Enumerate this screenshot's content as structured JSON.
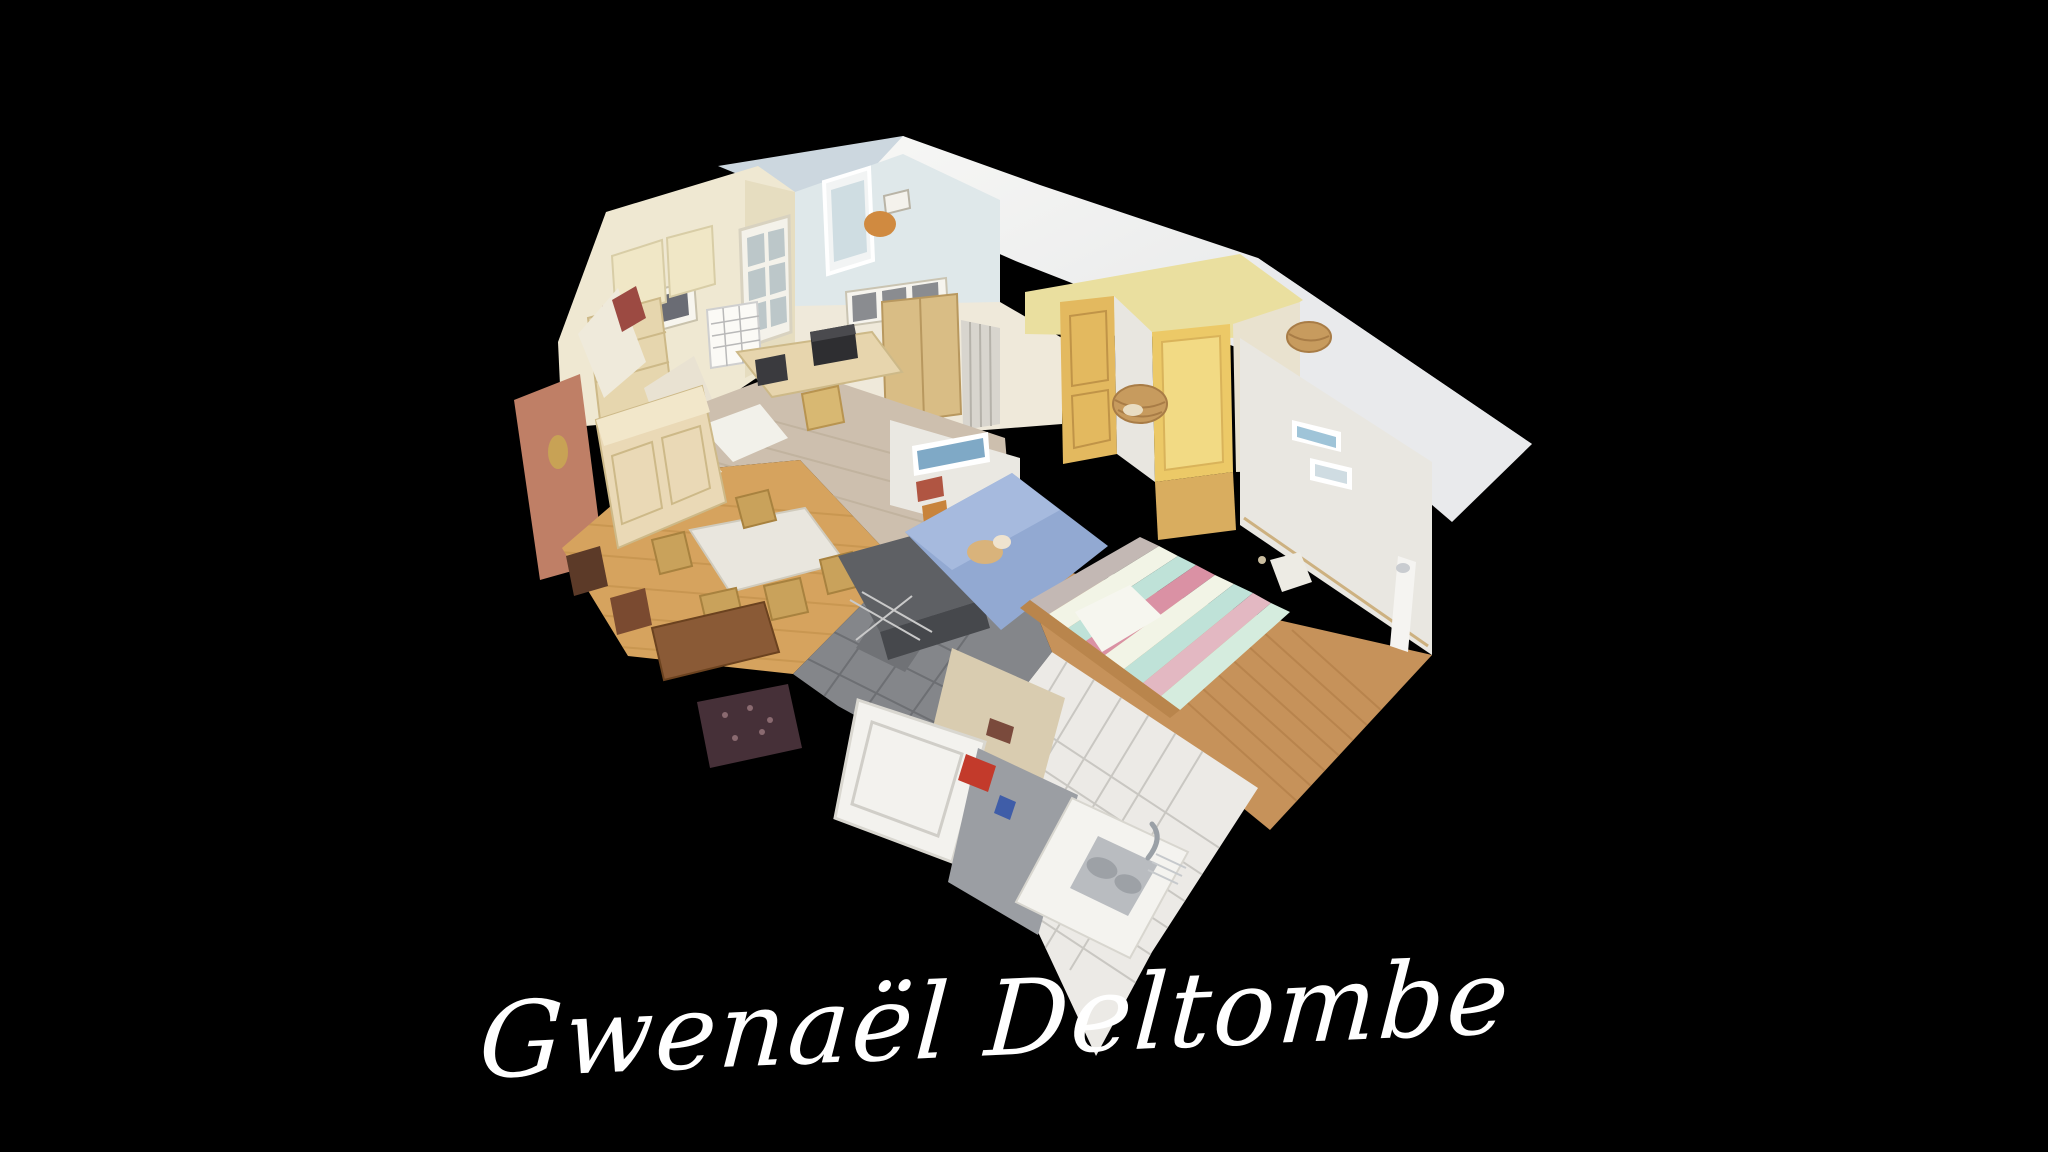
{
  "page": {
    "width_px": 2048,
    "height_px": 1152,
    "background_color": "#000000"
  },
  "scene": {
    "kind": "3d-dollhouse-cutaway",
    "subject": "apartment interior photogrammetry scan viewed from above on black backdrop",
    "rooms_visible": [
      "attic kitchen-dining room with cream gable wall and buffet",
      "office nook with pale blue wall, window, desk and printer",
      "hallway with yellow oak doors",
      "bedroom with blue single bed",
      "bedroom with striped double bed and rattan pendant lamps",
      "bathroom with grey slate floor and white fixtures",
      "white-tiled kitchen corner with steel sink"
    ]
  },
  "watermark": {
    "text": "Gwenaël Deltombe",
    "color": "#ffffff"
  },
  "palette": {
    "background": "#000000",
    "roof_white": "#f2f2f0",
    "roof_blue_gray": "#ccd7df",
    "wall_cream": "#efe8d2",
    "wall_pale_yellow": "#eadf9f",
    "wall_white": "#e9e7e1",
    "wall_pink": "#bf7f66",
    "door_yellow": "#e3b95f",
    "floor_oak": "#d6a35e",
    "floor_laminate": "#c6925a",
    "floor_slate": "#84868a",
    "floor_tile_white": "#eceae6",
    "bed_blue": "#92a9d2",
    "bed_stripe_mint": "#bfe2d8",
    "bed_stripe_pink": "#da91a4",
    "signature": "#ffffff"
  }
}
